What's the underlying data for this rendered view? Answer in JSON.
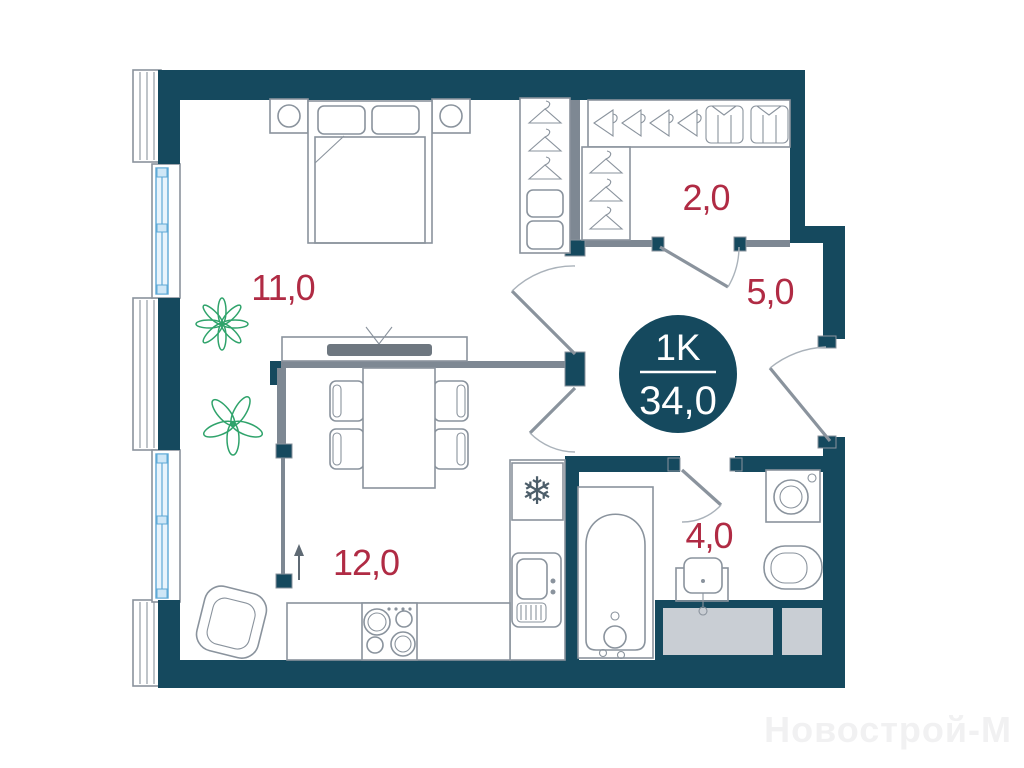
{
  "plan": {
    "badge": {
      "type": "1K",
      "area": "34,0"
    },
    "rooms": [
      {
        "name": "bedroom",
        "area": "11,0"
      },
      {
        "name": "living-kitchen",
        "area": "12,0"
      },
      {
        "name": "wardrobe",
        "area": "2,0"
      },
      {
        "name": "hallway",
        "area": "5,0"
      },
      {
        "name": "bathroom",
        "area": "4,0"
      }
    ],
    "icons": {
      "fridge": "❄"
    },
    "colors": {
      "wall": "#15495e",
      "partition": "#7e8893",
      "furniture_outline": "#8a939d",
      "room_label": "#b02b44",
      "plant": "#2fa36b",
      "window_glass": "#5ea9d6",
      "vent_shaft": "#c9ced4",
      "badge_text": "#ffffff",
      "watermark": "#f1f1f2"
    }
  },
  "watermark": {
    "text": "Новострой-М"
  }
}
